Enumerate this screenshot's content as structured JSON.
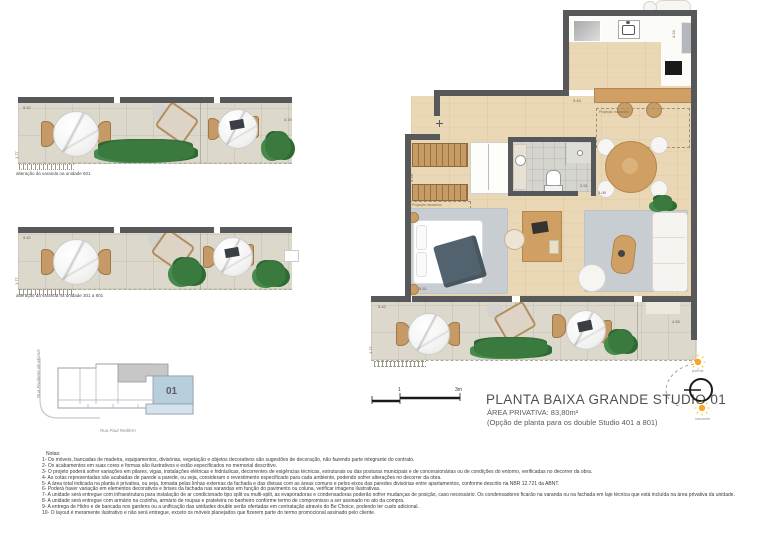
{
  "title_block": {
    "title": "PLANTA BAIXA GRANDE STUDIO 01",
    "area": "ÁREA PRIVATIVA: 83,80m²",
    "option": "(Opção de planta para os double Studio 401 a 801)"
  },
  "scale_bar": {
    "tick_mid": "1",
    "tick_end": "3m"
  },
  "compass": {
    "top_label": "poente",
    "bottom_label": "nascente"
  },
  "key_plan": {
    "unit": "01",
    "street_left": "Rua Prudente de Morais",
    "street_bottom": "Rua Paul Redfern"
  },
  "balcony_variants": [
    {
      "caption": "alteração da varanda na unidade 601",
      "dims": {
        "width": "5.42",
        "depth": "1.77",
        "right": "4.19"
      }
    },
    {
      "caption": "alteração da varanda na unidade 301 a 801",
      "dims": {
        "width": "5.42",
        "depth": "1.77"
      }
    }
  ],
  "main_plan": {
    "labels": {
      "mezzanine_kitchen": "Projeção mezanino",
      "mezzanine_stairs": "Projeção mezanino"
    },
    "dims": {
      "top": "3.43",
      "kitchen_right": "4.24",
      "stairs": "4.78",
      "bath_right_a": "2.51",
      "bath_right_b": "3.08",
      "bed_bottom": "5.51",
      "balcony_width": "5.42",
      "balcony_depth": "1.77",
      "balcony_right": "4.55"
    }
  },
  "notes": {
    "header": "Notas:",
    "items": [
      "1- Os móveis, bancadas de madeira, equipamentos, divisórias, vegetação e objetos decorativos são sugestões de decoração, não fazendo parte integrante do contrato.",
      "2- Os acabamentos em suas cores e formas são ilustrativos e estão especificados no memorial descritivo.",
      "3- O projeto poderá sofrer variações em pilares, vigas, instalações elétricas e hidráulicas, decorrentes de exigências técnicas, estruturais ou das posturas municipais e de concessionárias ou de condições do entorno, verificadas no decorrer da obra.",
      "4- As cotas representadas são acabadas de parede a parede, ou seja, consideram o revestimento especificado para cada ambiente, podendo sofrer alterações no decorrer da obra.",
      "5- A área total indicada na planta é privativa, ou seja, tomada pelas linhas externas da fachada e das divisas com as áreas comuns e pelos eixos das paredes divisórias entre apartamentos, conforme descrito na NBR 12.721 da ABNT.",
      "6- Poderá haver variação em elementos decorativos e brises da fachada nas varandas em função do pavimento ou coluna, verificar imagens ilustrativas.",
      "7- A unidade será entregue com infraestrutura para instalação de ar condicionado tipo split ou multi-split, as evaporadoras e condensadoras poderão sofrer mudanças de posição, caso necessário. Os condensadores ficarão na varanda ou na fachada em laje técnica que está incluída na área privativa da unidade.",
      "8- A unidade será entregue com armário na cozinha, armário de roupas e prateleira no banheiro conforme termo de compromisso a ser assinado no ato da compra.",
      "9- A entrega de Hidro e de bancada nos gardens ou a unificação das unidades double serão ofertadas em contratação através do Be Choice, podendo ter custo adicional.",
      "10- O layout é meramente ilustrativo e não será entregue, exceto os móveis planejados que fizerem parte do termo promocional assinado pelo cliente."
    ]
  },
  "colors": {
    "wall": "#57585a",
    "wood_floor": "#ead7b5",
    "balcony_floor": "#dcd8cb",
    "rug": "#c8cdd2",
    "furniture_wood": "#cf9f63",
    "plant": "#3a7a3e",
    "unit_highlight": "#b7cedd",
    "sun": "#f9a825",
    "title_text": "#4d4f53"
  }
}
